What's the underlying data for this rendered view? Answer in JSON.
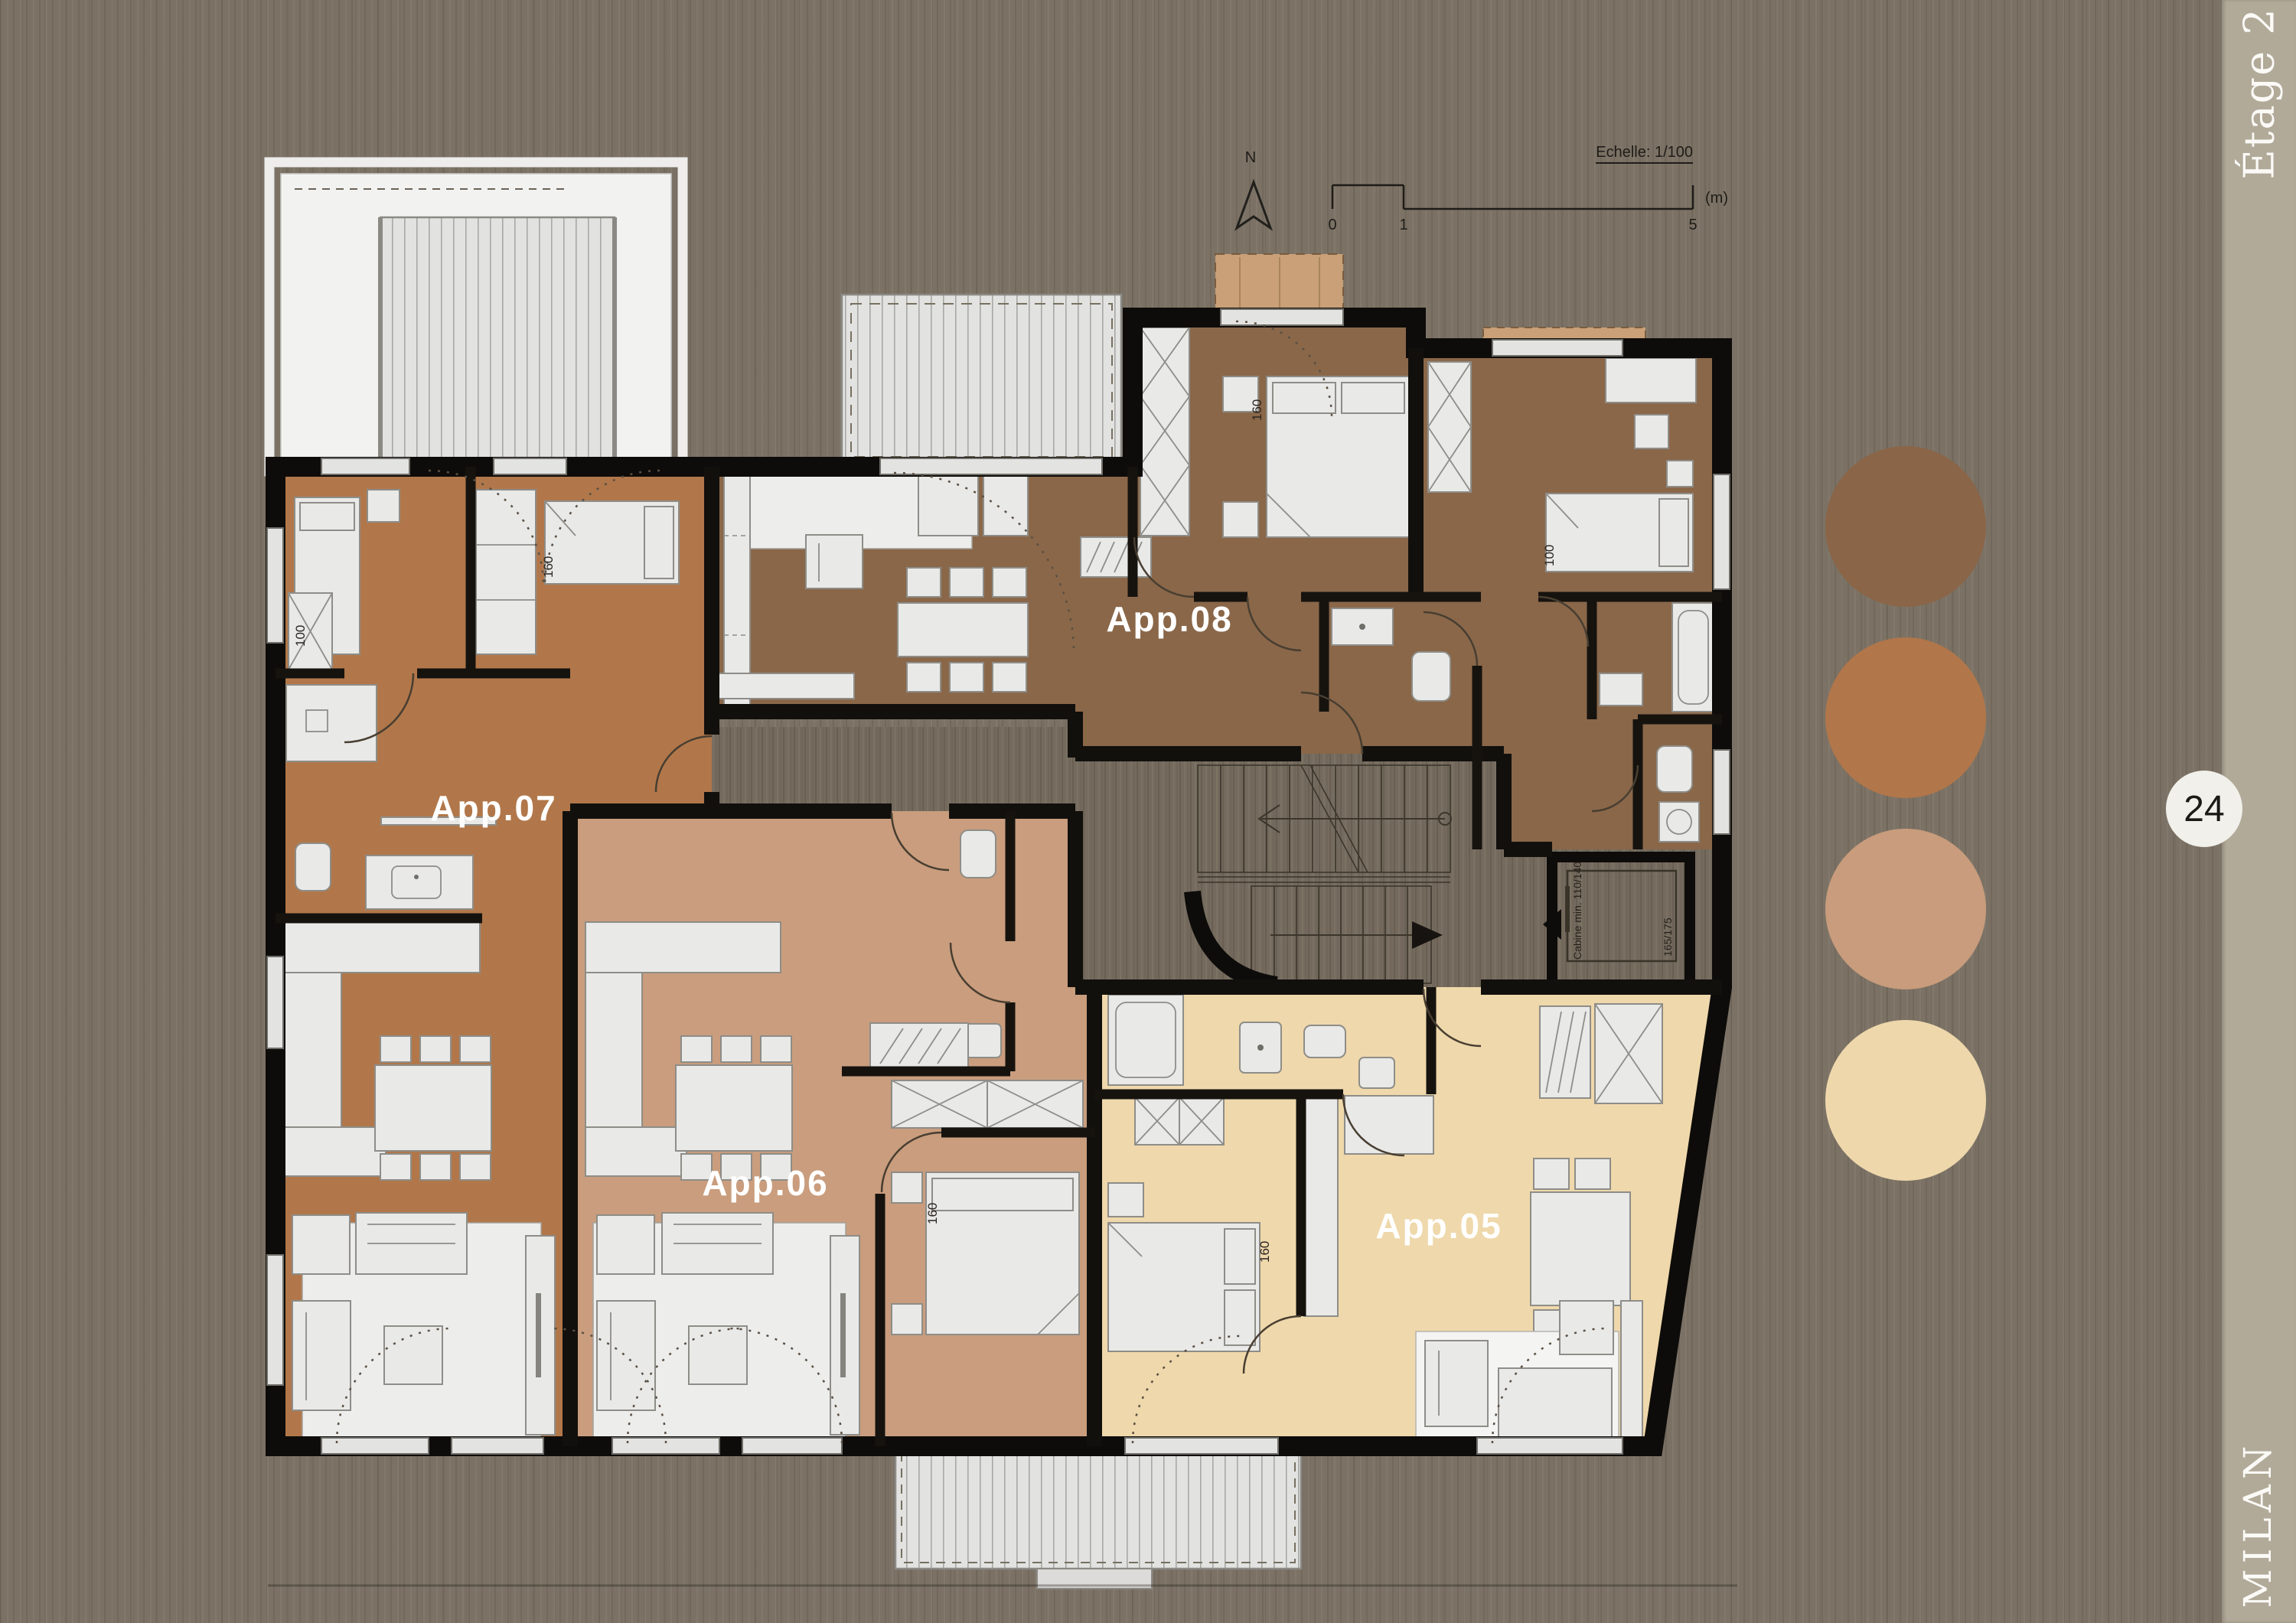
{
  "page": {
    "floor_label": "Étage 2",
    "page_number": "24",
    "brand": "MILAN"
  },
  "plan": {
    "north_label": "N",
    "scale": {
      "label": "Echelle: 1/100",
      "tick_0": "0",
      "tick_1": "1",
      "tick_5": "5",
      "unit": "(m)"
    },
    "apartments": [
      {
        "id": "app-08",
        "label": "App.08",
        "color": "#8a6749"
      },
      {
        "id": "app-07",
        "label": "App.07",
        "color": "#b1774a"
      },
      {
        "id": "app-06",
        "label": "App.06",
        "color": "#c99d7d"
      },
      {
        "id": "app-05",
        "label": "App.05",
        "color": "#efd8ab"
      }
    ],
    "bed_sizes": {
      "small": "100",
      "large": "160"
    },
    "elevator": {
      "cabin_label": "Cabine min. 110/140",
      "shaft_label": "165/175"
    }
  },
  "legend": {
    "swatches": [
      {
        "name": "app-08-color",
        "color": "#8a6548"
      },
      {
        "name": "app-07-color",
        "color": "#b1764a"
      },
      {
        "name": "app-06-color",
        "color": "#c89c7c"
      },
      {
        "name": "app-05-color",
        "color": "#eed7ab"
      }
    ]
  }
}
